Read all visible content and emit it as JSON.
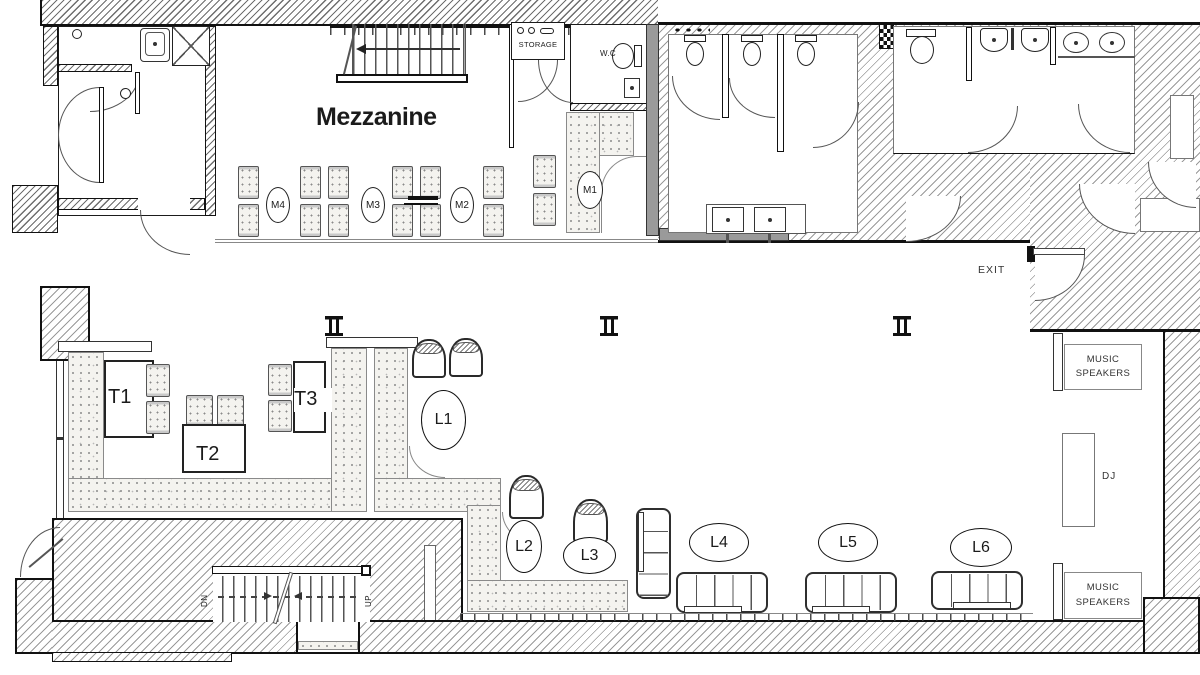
{
  "drawing": {
    "type": "floor-plan",
    "labels": {
      "mezzanine": "Mezzanine",
      "storage": "STORAGE",
      "wc": "W.C",
      "exit": "EXIT",
      "dj": "DJ",
      "music_speakers": "MUSIC SPEAKERS",
      "stairs_up": "UP",
      "stairs_down": "DN"
    },
    "mezzanine_tables": [
      {
        "id": "M4"
      },
      {
        "id": "M3"
      },
      {
        "id": "M2"
      },
      {
        "id": "M1"
      }
    ],
    "tables": [
      {
        "id": "T1"
      },
      {
        "id": "T2"
      },
      {
        "id": "T3"
      }
    ],
    "lounge_positions": [
      {
        "id": "L1"
      },
      {
        "id": "L2"
      },
      {
        "id": "L3"
      },
      {
        "id": "L4"
      },
      {
        "id": "L5"
      },
      {
        "id": "L6"
      }
    ],
    "colors": {
      "line": "#1b1b1b",
      "hatch": "#9a9a9a",
      "dark_wall": "#9a9a9a",
      "stipple_bg": "#f4f3ef"
    }
  }
}
